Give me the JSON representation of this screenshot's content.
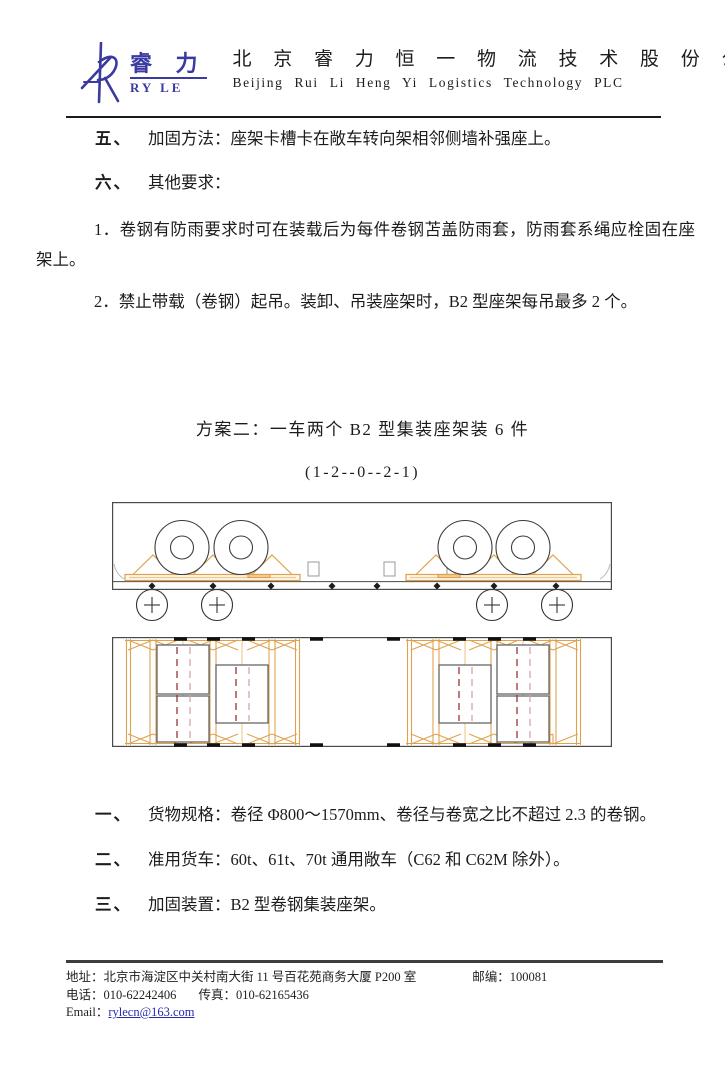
{
  "header": {
    "logo_cn": "睿 力",
    "logo_en": "RY LE",
    "company_cn": "北 京 睿 力 恒 一 物 流 技 术 股 份 公 司",
    "company_en": "Beijing  Rui  Li  Heng  Yi  Logistics  Technology  PLC"
  },
  "sections": {
    "item5_num": "五、",
    "item5_text": "加固方法：座架卡槽卡在敞车转向架相邻侧墙补强座上。",
    "item6_num": "六、",
    "item6_text": "其他要求：",
    "note1": "1．卷钢有防雨要求时可在装载后为每件卷钢苫盖防雨套，防雨套系绳应栓固在座架上。",
    "note2": "2．禁止带载（卷钢）起吊。装卸、吊装座架时，B2 型座架每吊最多 2 个。",
    "plan_title": "方案二：一车两个 B2 型集装座架装 6 件",
    "plan_code": "(1-2--0--2-1)",
    "item1_num": "一、",
    "item1_text": "货物规格：卷径 Φ800～1570mm、卷径与卷宽之比不超过 2.3 的卷钢。",
    "item2_num": "二、",
    "item2_text": "准用货车：60t、61t、70t 通用敞车（C62 和 C62M 除外）。",
    "item3_num": "三、",
    "item3_text": "加固装置：B2 型卷钢集装座架。"
  },
  "footer": {
    "address_label": "地址：",
    "address": "北京市海淀区中关村南大街 11 号百花苑商务大厦 P200 室",
    "postcode_label": "邮编：",
    "postcode": "100081",
    "phone_label": "电话：",
    "phone": "010-62242406",
    "fax_label": "传真：",
    "fax": "010-62165436",
    "email_label": "Email：",
    "email": "rylecn@163.com"
  },
  "colors": {
    "logo_blue": "#3a3aa0",
    "rack_orange": "#e0a14e",
    "rack_orange_light": "#f0c88e",
    "coil_outline": "#3c3c3c",
    "coil_rect_outline": "#666666",
    "dash_dark": "#993333",
    "dash_light": "#d6a6a6",
    "car_outline": "#4a4a4a",
    "pocket_gray": "#9a9a9a",
    "mark_black": "#111111"
  }
}
